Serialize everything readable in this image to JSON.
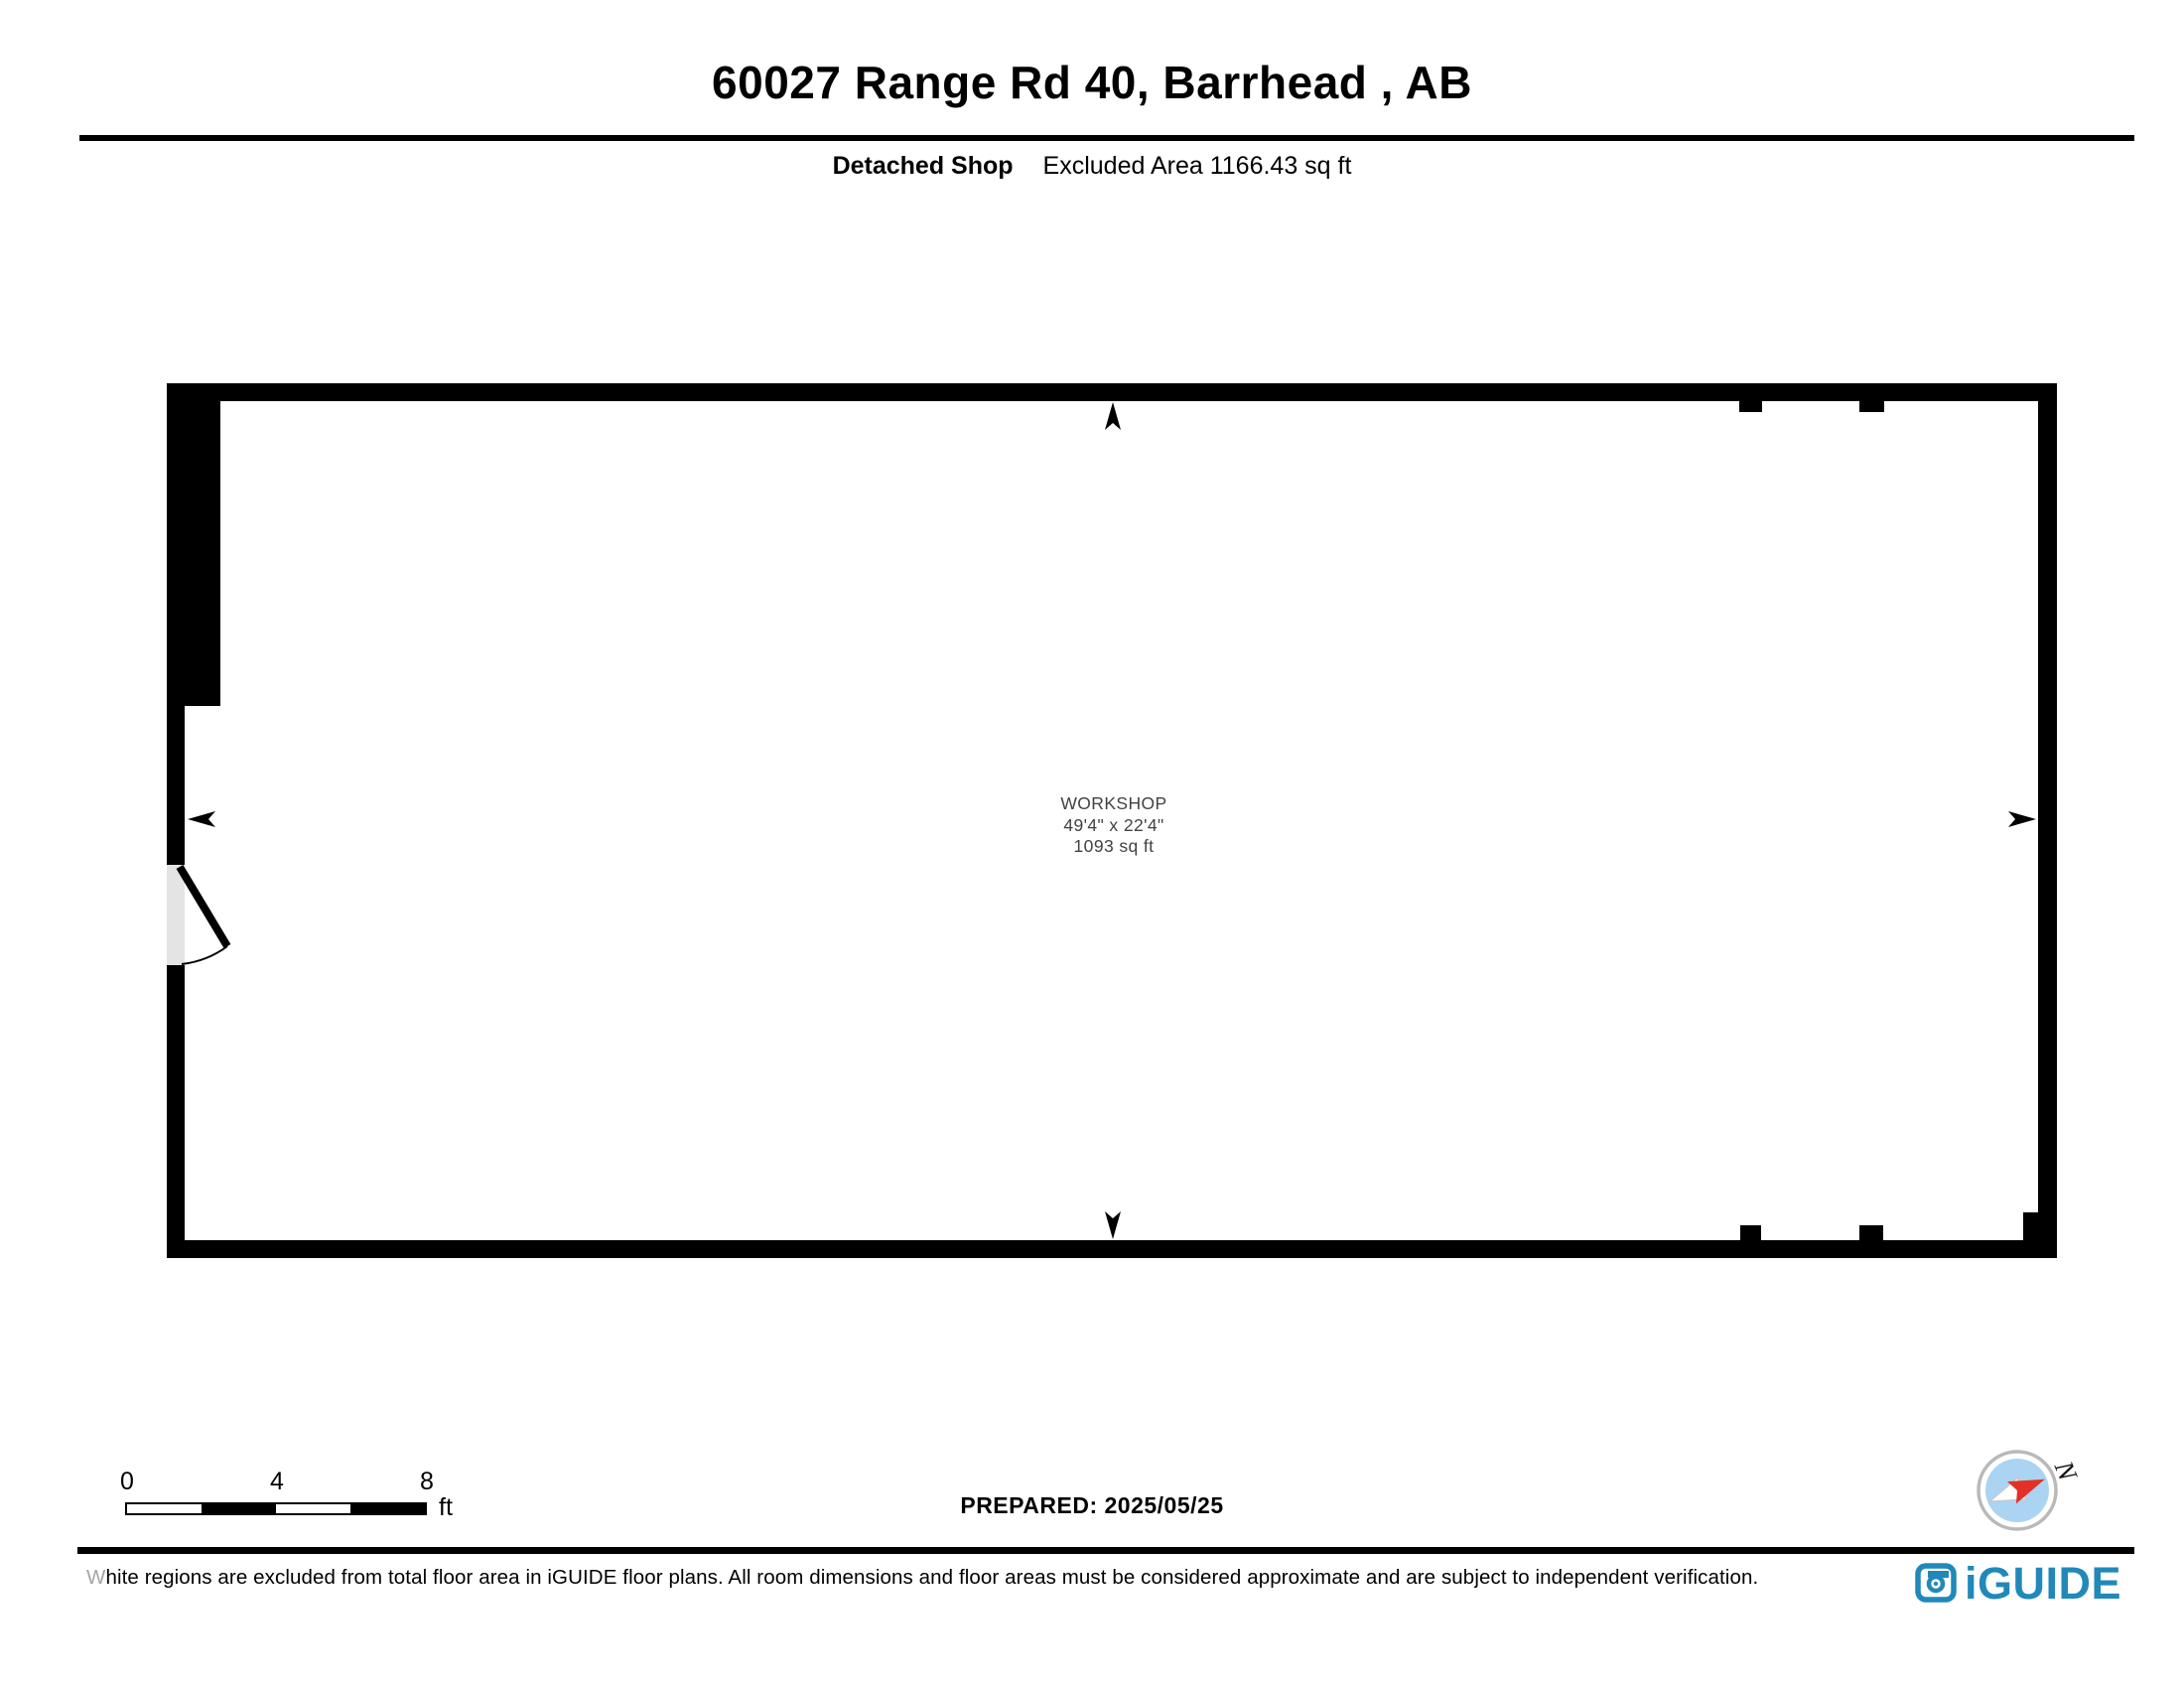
{
  "header": {
    "title": "60027 Range Rd 40, Barrhead , AB",
    "floor_label": "Detached Shop",
    "excluded_area_label": "Excluded Area 1166.43 sq ft"
  },
  "plan": {
    "room": {
      "name": "WORKSHOP",
      "dimensions": "49'4\" x 22'4\"",
      "area": "1093 sq ft"
    }
  },
  "footer": {
    "scale_bar": {
      "ticks": [
        "0",
        "4",
        "8"
      ],
      "unit": "ft"
    },
    "prepared_label": "PREPARED: 2025/05/25",
    "compass_north_label": "N",
    "disclaimer": "White regions are excluded from total floor area in iGUIDE floor plans. All room dimensions and floor areas must be considered approximate and are subject to independent verification.",
    "brand_logo_text": "iGUIDE"
  },
  "colors": {
    "walls": "#000000",
    "door_opening_fill": "#e4e4e4",
    "room_label_text": "#424242",
    "brand_blue": "#2189b9",
    "compass_fill": "#aad4f2",
    "compass_ring": "#b9b9b9",
    "compass_needle_red": "#e33127",
    "compass_needle_white": "#ffffff"
  }
}
